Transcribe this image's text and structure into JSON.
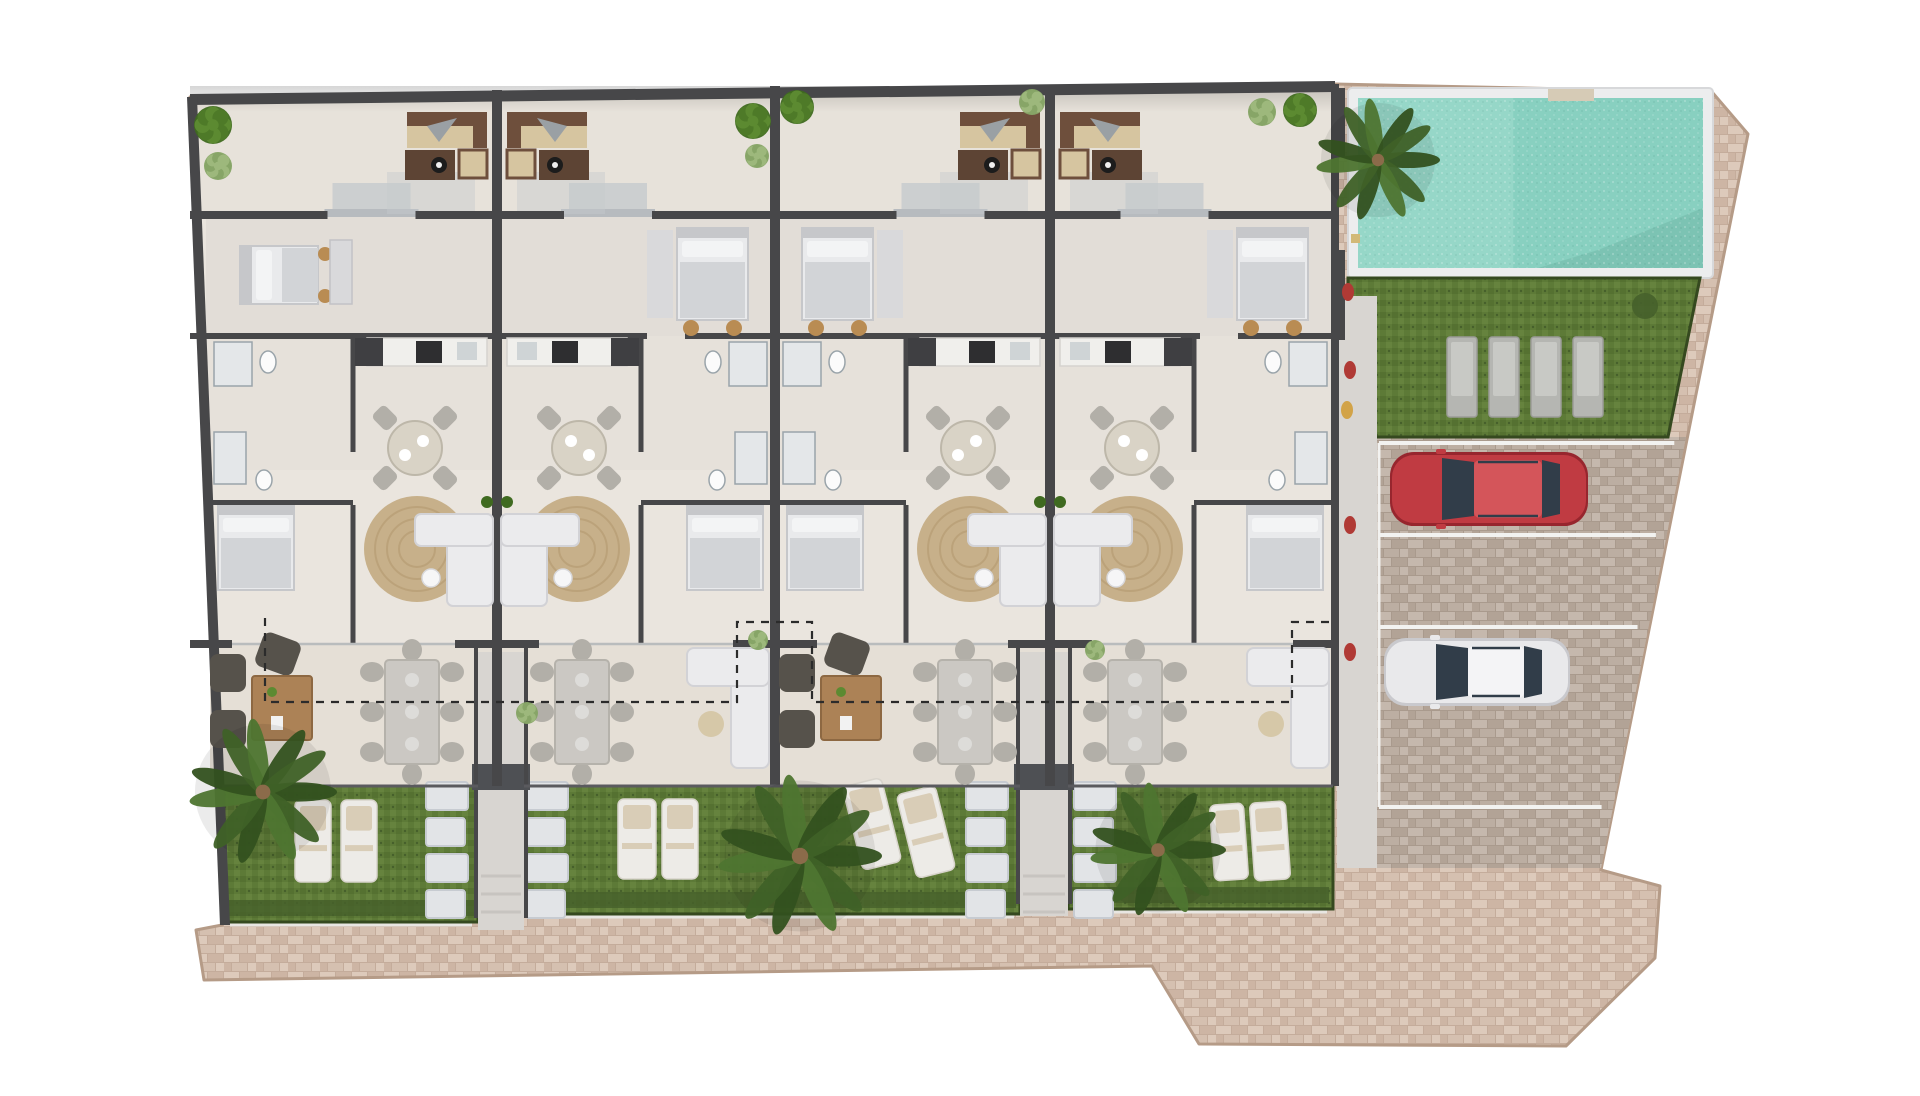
{
  "scene": {
    "width": 1920,
    "height": 1096,
    "background": "#ffffff",
    "label": "residential-complex-ground-floor-site-plan"
  },
  "palette": {
    "paving_base": "#d5c0b0",
    "paving_a": "#ddcabb",
    "paving_b": "#cdb5a4",
    "paving_gap": "#c4ac9b",
    "paving_edge": "#b59b87",
    "parking_base": "#bcaea2",
    "parking_a": "#c5b8ad",
    "parking_b": "#b2a396",
    "wall": "#474749",
    "wall_light": "#5a5a5e",
    "floor": "#eae5de",
    "floor_patio": "#e7e2da",
    "floor_bed": "#e2ddd7",
    "floor_mid": "#e6e1da",
    "floor_terrace": "#e5dfd6",
    "walkway": "#d8d5d1",
    "porch": "#c6cacd",
    "threshold": "#b7bbbf",
    "grass": "#5d7a37",
    "grass_a": "#557131",
    "grass_b": "#66833e",
    "grass_dark": "#46602b",
    "grass_border": "#35491f",
    "pool_water": "#88d0c0",
    "pool_light": "#a2dccd",
    "pool_dark": "#66ab9b",
    "pool_rim": "#ecedee",
    "pool_rim_edge": "#d7d8da",
    "rug": "#c7b08a",
    "rug_ring": "#b69d74",
    "wood": "#ac8256",
    "fire_table": "#5d4434",
    "sofa_brown": "#6e4f3c",
    "sofa_cushion": "#d6c5a0",
    "sofa_throw": "#9aa0a4",
    "bed_mattress": "#e9eaec",
    "bed_blanket": "#d2d4d7",
    "bed_frame": "#c6c7ca",
    "pillow": "#f3f4f5",
    "stool": "#b98c53",
    "table_gray": "#cbc8c3",
    "chair_gray": "#b2afa8",
    "chair_seat": "#cfc2a0",
    "white_sofa": "#ebebed",
    "white_sofa_edge": "#d2d2d6",
    "stone": "#e2e4e7",
    "stone_edge": "#c7cbd1",
    "lounger_white": "#edebe7",
    "lounger_towel": "#d9cdb7",
    "lounger_gray": "#b5b6b2",
    "lounger_gray_in": "#c8c9c5",
    "palm_dark": "#33511f",
    "palm_mid": "#3f6127",
    "palm_light": "#4e7530",
    "trunk": "#8b6b4a",
    "tree_a": "#4e7a28",
    "tree_b": "#5c8a31",
    "tree_c": "#3f6a20",
    "bush_a": "#9db87c",
    "bush_b": "#87a567",
    "car_red": "#c03b42",
    "car_red_dark": "#97262e",
    "car_red_light": "#d4555a",
    "car_white": "#e9e9eb",
    "car_white_dark": "#c9c9cd",
    "car_window": "#313d49",
    "line_white": "#f2f2f0",
    "dashed": "#2b2b2b",
    "accent_red": "#b03a35",
    "accent_yellow": "#d2a348",
    "counter": "#f0efec",
    "cooktop": "#2e2e30",
    "dark_block": "#3f3f42",
    "fixture": "#e4e7e9",
    "fixture_edge": "#9aa4aa",
    "shadow": "#000000"
  },
  "site": {
    "outline": [
      [
        190,
        97
      ],
      [
        1335,
        84
      ],
      [
        1712,
        92
      ],
      [
        1748,
        134
      ],
      [
        1601,
        870
      ],
      [
        1660,
        886
      ],
      [
        1655,
        958
      ],
      [
        1566,
        1046
      ],
      [
        1199,
        1044
      ],
      [
        1152,
        966
      ],
      [
        204,
        980
      ],
      [
        196,
        930
      ],
      [
        222,
        925
      ]
    ],
    "left_wall": {
      "top": [
        190,
        97
      ],
      "bottom": [
        222,
        925
      ]
    }
  },
  "building": {
    "right": 1335,
    "top_left_y": 97,
    "top_right_y": 84,
    "bands": {
      "patio": [
        92,
        215
      ],
      "bedroom": [
        215,
        336
      ],
      "service": [
        336,
        470
      ],
      "living": [
        336,
        644
      ],
      "terrace": [
        644,
        786
      ],
      "garden_top": 786
    },
    "units": [
      {
        "x0": 190,
        "x1": 497,
        "pair_wall": "right",
        "bed_wall": "left",
        "decor": "armchairs",
        "bed1_orientation": "horizontal"
      },
      {
        "x0": 497,
        "x1": 775,
        "pair_wall": "left",
        "bed_wall": "right",
        "decor": "white_sofa",
        "bed1_orientation": "vertical"
      },
      {
        "x0": 775,
        "x1": 1050,
        "pair_wall": "right",
        "bed_wall": "left",
        "decor": "armchairs",
        "bed1_orientation": "vertical"
      },
      {
        "x0": 1050,
        "x1": 1335,
        "pair_wall": "left",
        "bed_wall": "right",
        "decor": "white_sofa",
        "bed1_orientation": "vertical"
      }
    ],
    "pair_walls": [
      497,
      1050
    ],
    "mid_wall": 775
  },
  "walkways": [
    {
      "x0": 478,
      "x1": 524,
      "y0": 652,
      "y1": 930
    },
    {
      "x0": 1020,
      "x1": 1068,
      "y0": 652,
      "y1": 916
    }
  ],
  "garden": {
    "strips": [
      {
        "x0": 224,
        "x1": 478,
        "y1": 922
      },
      {
        "x0": 524,
        "x1": 1020,
        "y1": 914
      },
      {
        "x0": 1068,
        "x1": 1333,
        "y1": 909
      }
    ],
    "y0": 786,
    "stones": {
      "cols": [
        426,
        526,
        966,
        1074
      ],
      "ys": [
        782,
        818,
        854,
        890
      ],
      "w": 42,
      "h": 28
    },
    "loungers": [
      {
        "x": 295,
        "y": 800,
        "w": 36,
        "h": 82,
        "rot": 0
      },
      {
        "x": 341,
        "y": 800,
        "w": 36,
        "h": 82,
        "rot": 0
      },
      {
        "x": 618,
        "y": 799,
        "w": 38,
        "h": 80,
        "rot": 0
      },
      {
        "x": 662,
        "y": 799,
        "w": 36,
        "h": 80,
        "rot": 0
      },
      {
        "x": 852,
        "y": 781,
        "w": 40,
        "h": 86,
        "rot": -14
      },
      {
        "x": 906,
        "y": 789,
        "w": 40,
        "h": 86,
        "rot": -14
      },
      {
        "x": 1212,
        "y": 804,
        "w": 34,
        "h": 76,
        "rot": -4
      },
      {
        "x": 1252,
        "y": 802,
        "w": 36,
        "h": 78,
        "rot": -4
      }
    ]
  },
  "pool": {
    "rim": [
      1348,
      88,
      1713,
      278
    ],
    "water": [
      1358,
      98,
      1703,
      268
    ],
    "steps": [
      1548,
      89,
      46,
      12
    ],
    "ladder": [
      1351,
      234,
      9,
      9
    ]
  },
  "pool_lawn": {
    "poly": [
      [
        1348,
        278
      ],
      [
        1700,
        278
      ],
      [
        1668,
        437
      ],
      [
        1348,
        437
      ]
    ],
    "loungers": {
      "x0": 1447,
      "dx": 42,
      "y": 337,
      "w": 30,
      "h": 80,
      "count": 4
    },
    "bush": [
      1645,
      306,
      13
    ]
  },
  "parking": {
    "poly": [
      [
        1377,
        437
      ],
      [
        1686,
        437
      ],
      [
        1601,
        868
      ],
      [
        1377,
        868
      ]
    ],
    "lines_y": [
      443,
      535,
      627,
      807
    ],
    "left_line_x": 1379,
    "cars": [
      {
        "name": "red-car",
        "x": 1390,
        "y": 452,
        "l": 198,
        "w": 74,
        "color_key": "red"
      },
      {
        "name": "white-car",
        "x": 1384,
        "y": 638,
        "l": 186,
        "w": 68,
        "color_key": "white"
      }
    ]
  },
  "right_walkway": {
    "x0": 1337,
    "x1": 1377,
    "y0": 296,
    "y1": 868,
    "dots": [
      {
        "x": 1350,
        "y": 370,
        "c": "accent_red"
      },
      {
        "x": 1347,
        "y": 410,
        "c": "accent_yellow"
      },
      {
        "x": 1350,
        "y": 525,
        "c": "accent_red"
      },
      {
        "x": 1350,
        "y": 652,
        "c": "accent_red"
      },
      {
        "x": 1348,
        "y": 292,
        "c": "accent_red"
      }
    ],
    "wall_segments": [
      [
        88,
        70
      ],
      [
        250,
        90
      ]
    ]
  },
  "dashed_boundary": {
    "path": [
      [
        265,
        618
      ],
      [
        265,
        702
      ],
      [
        737,
        702
      ],
      [
        737,
        622
      ],
      [
        812,
        622
      ],
      [
        812,
        702
      ],
      [
        1292,
        702
      ],
      [
        1292,
        622
      ],
      [
        1335,
        622
      ]
    ]
  },
  "vegetation": {
    "palms": [
      {
        "x": 1378,
        "y": 160,
        "r": 62
      },
      {
        "x": 263,
        "y": 792,
        "r": 74
      },
      {
        "x": 800,
        "y": 856,
        "r": 82
      },
      {
        "x": 1158,
        "y": 850,
        "r": 68
      }
    ],
    "trees": [
      {
        "x": 213,
        "y": 125,
        "r": 19
      },
      {
        "x": 753,
        "y": 121,
        "r": 18
      },
      {
        "x": 797,
        "y": 107,
        "r": 17
      },
      {
        "x": 1300,
        "y": 110,
        "r": 17
      }
    ],
    "bushes": [
      {
        "x": 218,
        "y": 166,
        "r": 14
      },
      {
        "x": 757,
        "y": 156,
        "r": 12
      },
      {
        "x": 1032,
        "y": 102,
        "r": 13
      },
      {
        "x": 1262,
        "y": 112,
        "r": 14
      },
      {
        "x": 527,
        "y": 713,
        "r": 11
      },
      {
        "x": 758,
        "y": 640,
        "r": 10
      },
      {
        "x": 1095,
        "y": 650,
        "r": 10
      }
    ]
  }
}
